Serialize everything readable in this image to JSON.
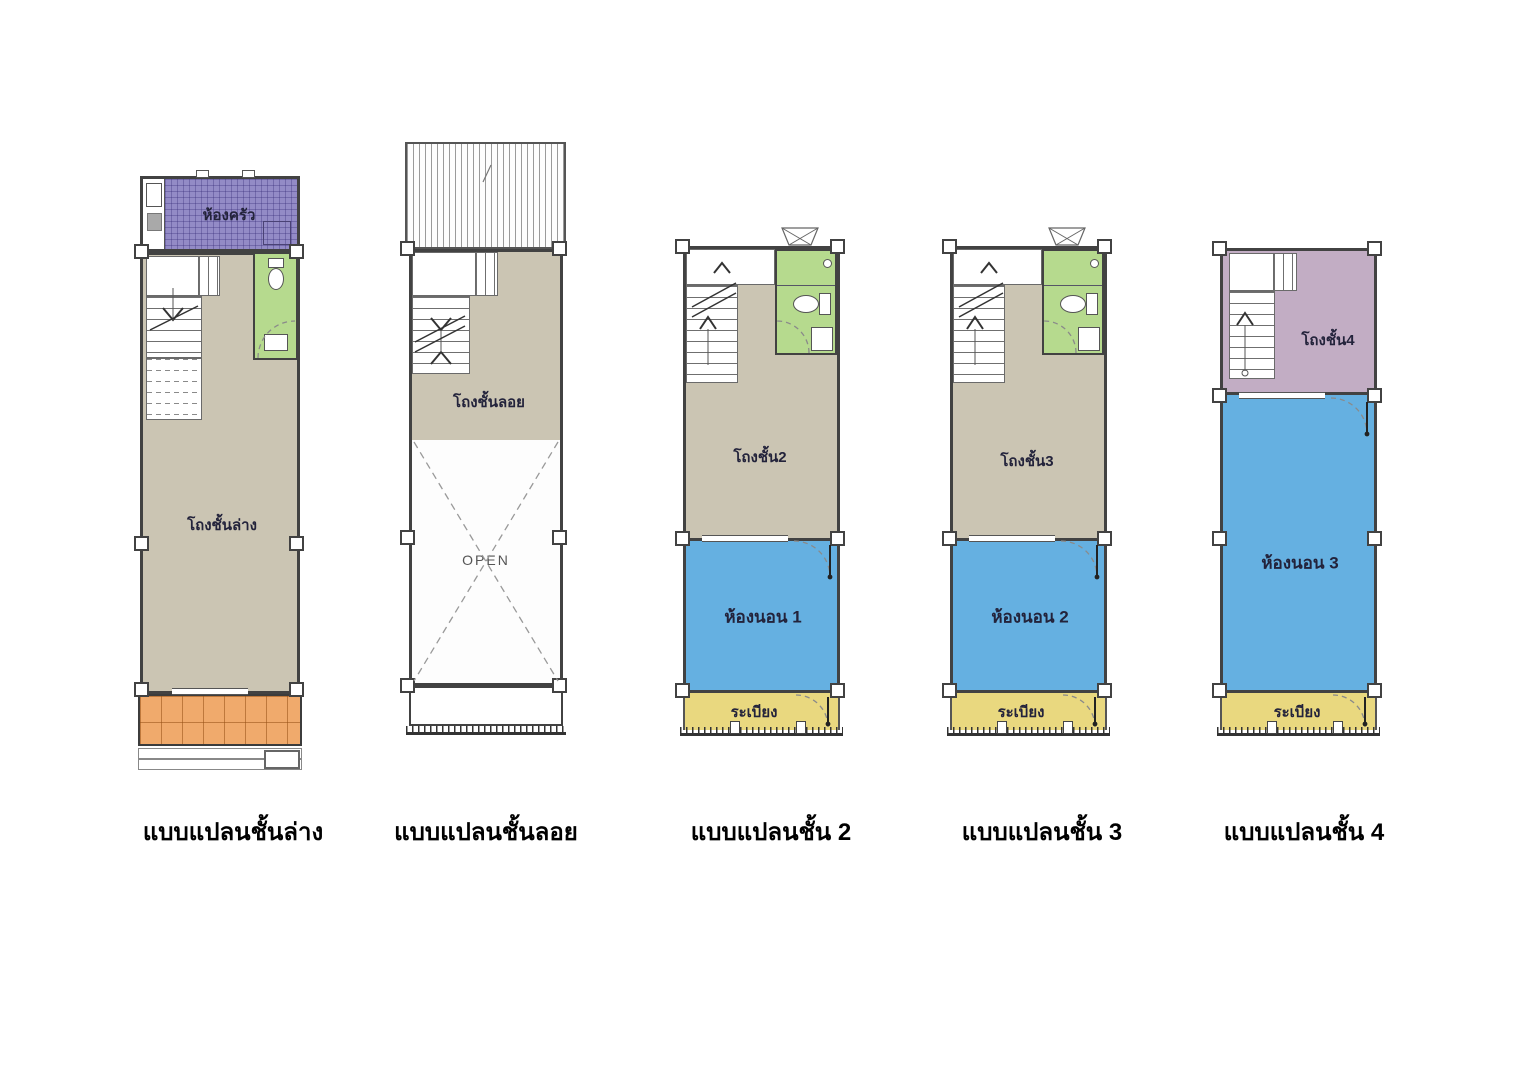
{
  "colors": {
    "wall": "#424242",
    "tan": "#cbc5b3",
    "purple": "#938bc6",
    "green": "#b6da8e",
    "blue": "#65b0e1",
    "yellow": "#e9d87f",
    "orange": "#f0aa6c",
    "mauve": "#c2adc4"
  },
  "plans": [
    {
      "caption": "แบบแปลนชั้นล่าง",
      "rooms": {
        "kitchen": "ห้องครัว",
        "hall": "โถงชั้นล่าง"
      }
    },
    {
      "caption": "แบบแปลนชั้นลอย",
      "rooms": {
        "hall": "โถงชั้นลอย",
        "open": "OPEN"
      }
    },
    {
      "caption": "แบบแปลนชั้น 2",
      "rooms": {
        "hall": "โถงชั้น2",
        "bedroom": "ห้องนอน  1",
        "balcony": "ระเบียง"
      }
    },
    {
      "caption": "แบบแปลนชั้น 3",
      "rooms": {
        "hall": "โถงชั้น3",
        "bedroom": "ห้องนอน  2",
        "balcony": "ระเบียง"
      }
    },
    {
      "caption": "แบบแปลนชั้น 4",
      "rooms": {
        "hall": "โถงชั้น4",
        "bedroom": "ห้องนอน  3",
        "balcony": "ระเบียง"
      }
    }
  ]
}
